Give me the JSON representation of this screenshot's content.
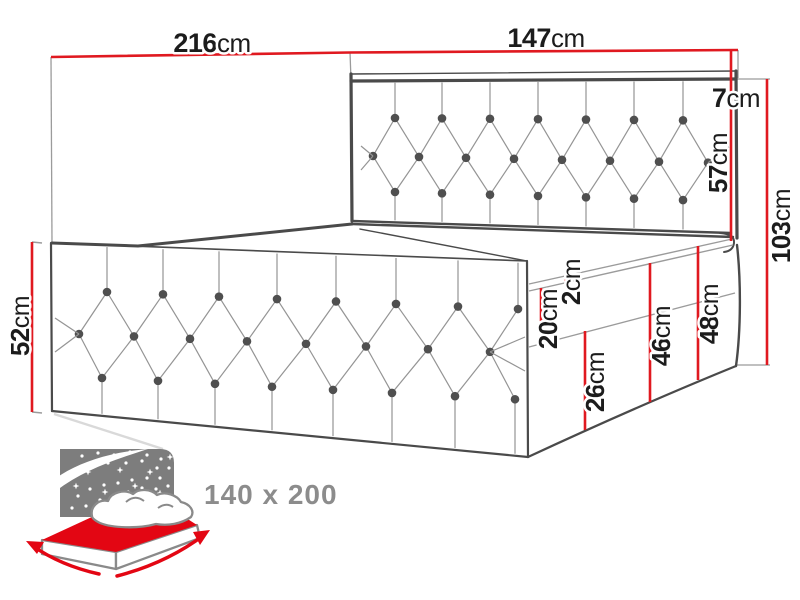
{
  "diagram_type": "bed-dimension-drawing",
  "dims": {
    "bed_length": {
      "value": "216",
      "unit": "cm"
    },
    "headboard_width": {
      "value": "147",
      "unit": "cm"
    },
    "headboard_top_depth": {
      "value": "7",
      "unit": "cm"
    },
    "headboard_height": {
      "value": "57",
      "unit": "cm"
    },
    "total_height": {
      "value": "103",
      "unit": "cm"
    },
    "side_height": {
      "value": "52",
      "unit": "cm"
    },
    "mattress_welt": {
      "value": "2",
      "unit": "cm"
    },
    "mattress_section": {
      "value": "20",
      "unit": "cm"
    },
    "base_lower_section": {
      "value": "26",
      "unit": "cm"
    },
    "base_mid_height": {
      "value": "46",
      "unit": "cm"
    },
    "base_top_height": {
      "value": "48",
      "unit": "cm"
    }
  },
  "badge": {
    "label": "140 x 200"
  },
  "colors": {
    "dimension_red": "#e01920",
    "icon_red": "#e30613",
    "outline_gray": "#4a4a4a",
    "thin_gray": "#9b9b9b",
    "tuft_gray": "#949494",
    "button_gray": "#4f4f4f",
    "icon_gray": "#7d7d7d",
    "badge_gray": "#8c8c8c",
    "label_black": "#1c1c1c"
  }
}
